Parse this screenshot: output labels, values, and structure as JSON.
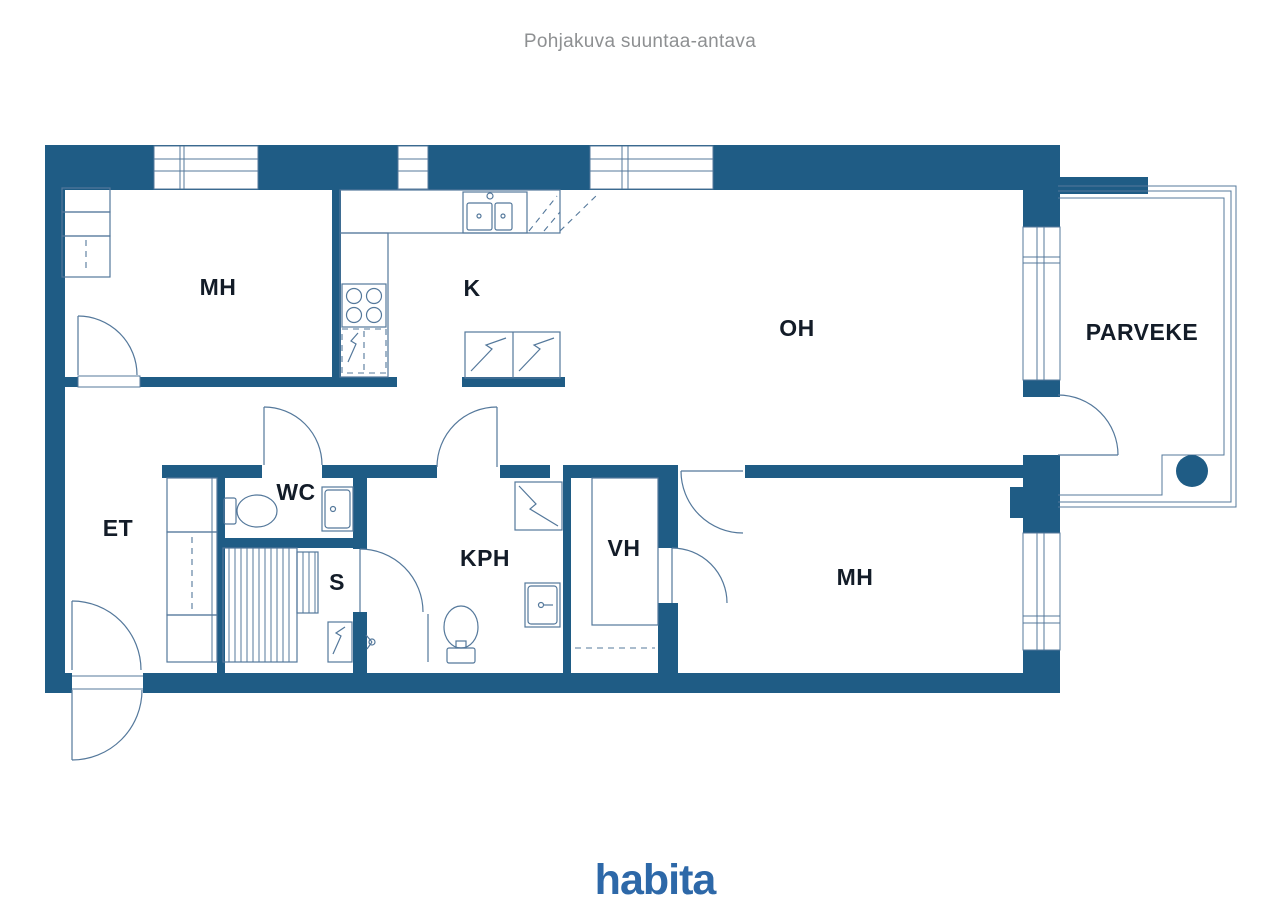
{
  "page": {
    "title": "Pohjakuva suuntaa-antava"
  },
  "branding": {
    "logo_text": "habita"
  },
  "colors": {
    "wall": "#1f5c85",
    "line": "#54789b",
    "label": "#131c28",
    "title": "#8e9092",
    "logo": "#2d68a8",
    "bg": "#ffffff"
  },
  "floor_plan": {
    "disclaimer": "Pohjakuva suuntaa-antava",
    "rooms": [
      {
        "label": "MH",
        "name": "bedroom-1"
      },
      {
        "label": "K",
        "name": "kitchen"
      },
      {
        "label": "OH",
        "name": "living-room"
      },
      {
        "label": "PARVEKE",
        "name": "balcony"
      },
      {
        "label": "ET",
        "name": "entrance-hall"
      },
      {
        "label": "WC",
        "name": "toilet-room"
      },
      {
        "label": "S",
        "name": "sauna"
      },
      {
        "label": "KPH",
        "name": "bathroom"
      },
      {
        "label": "VH",
        "name": "walk-in-closet"
      },
      {
        "label": "MH",
        "name": "bedroom-2"
      }
    ]
  }
}
